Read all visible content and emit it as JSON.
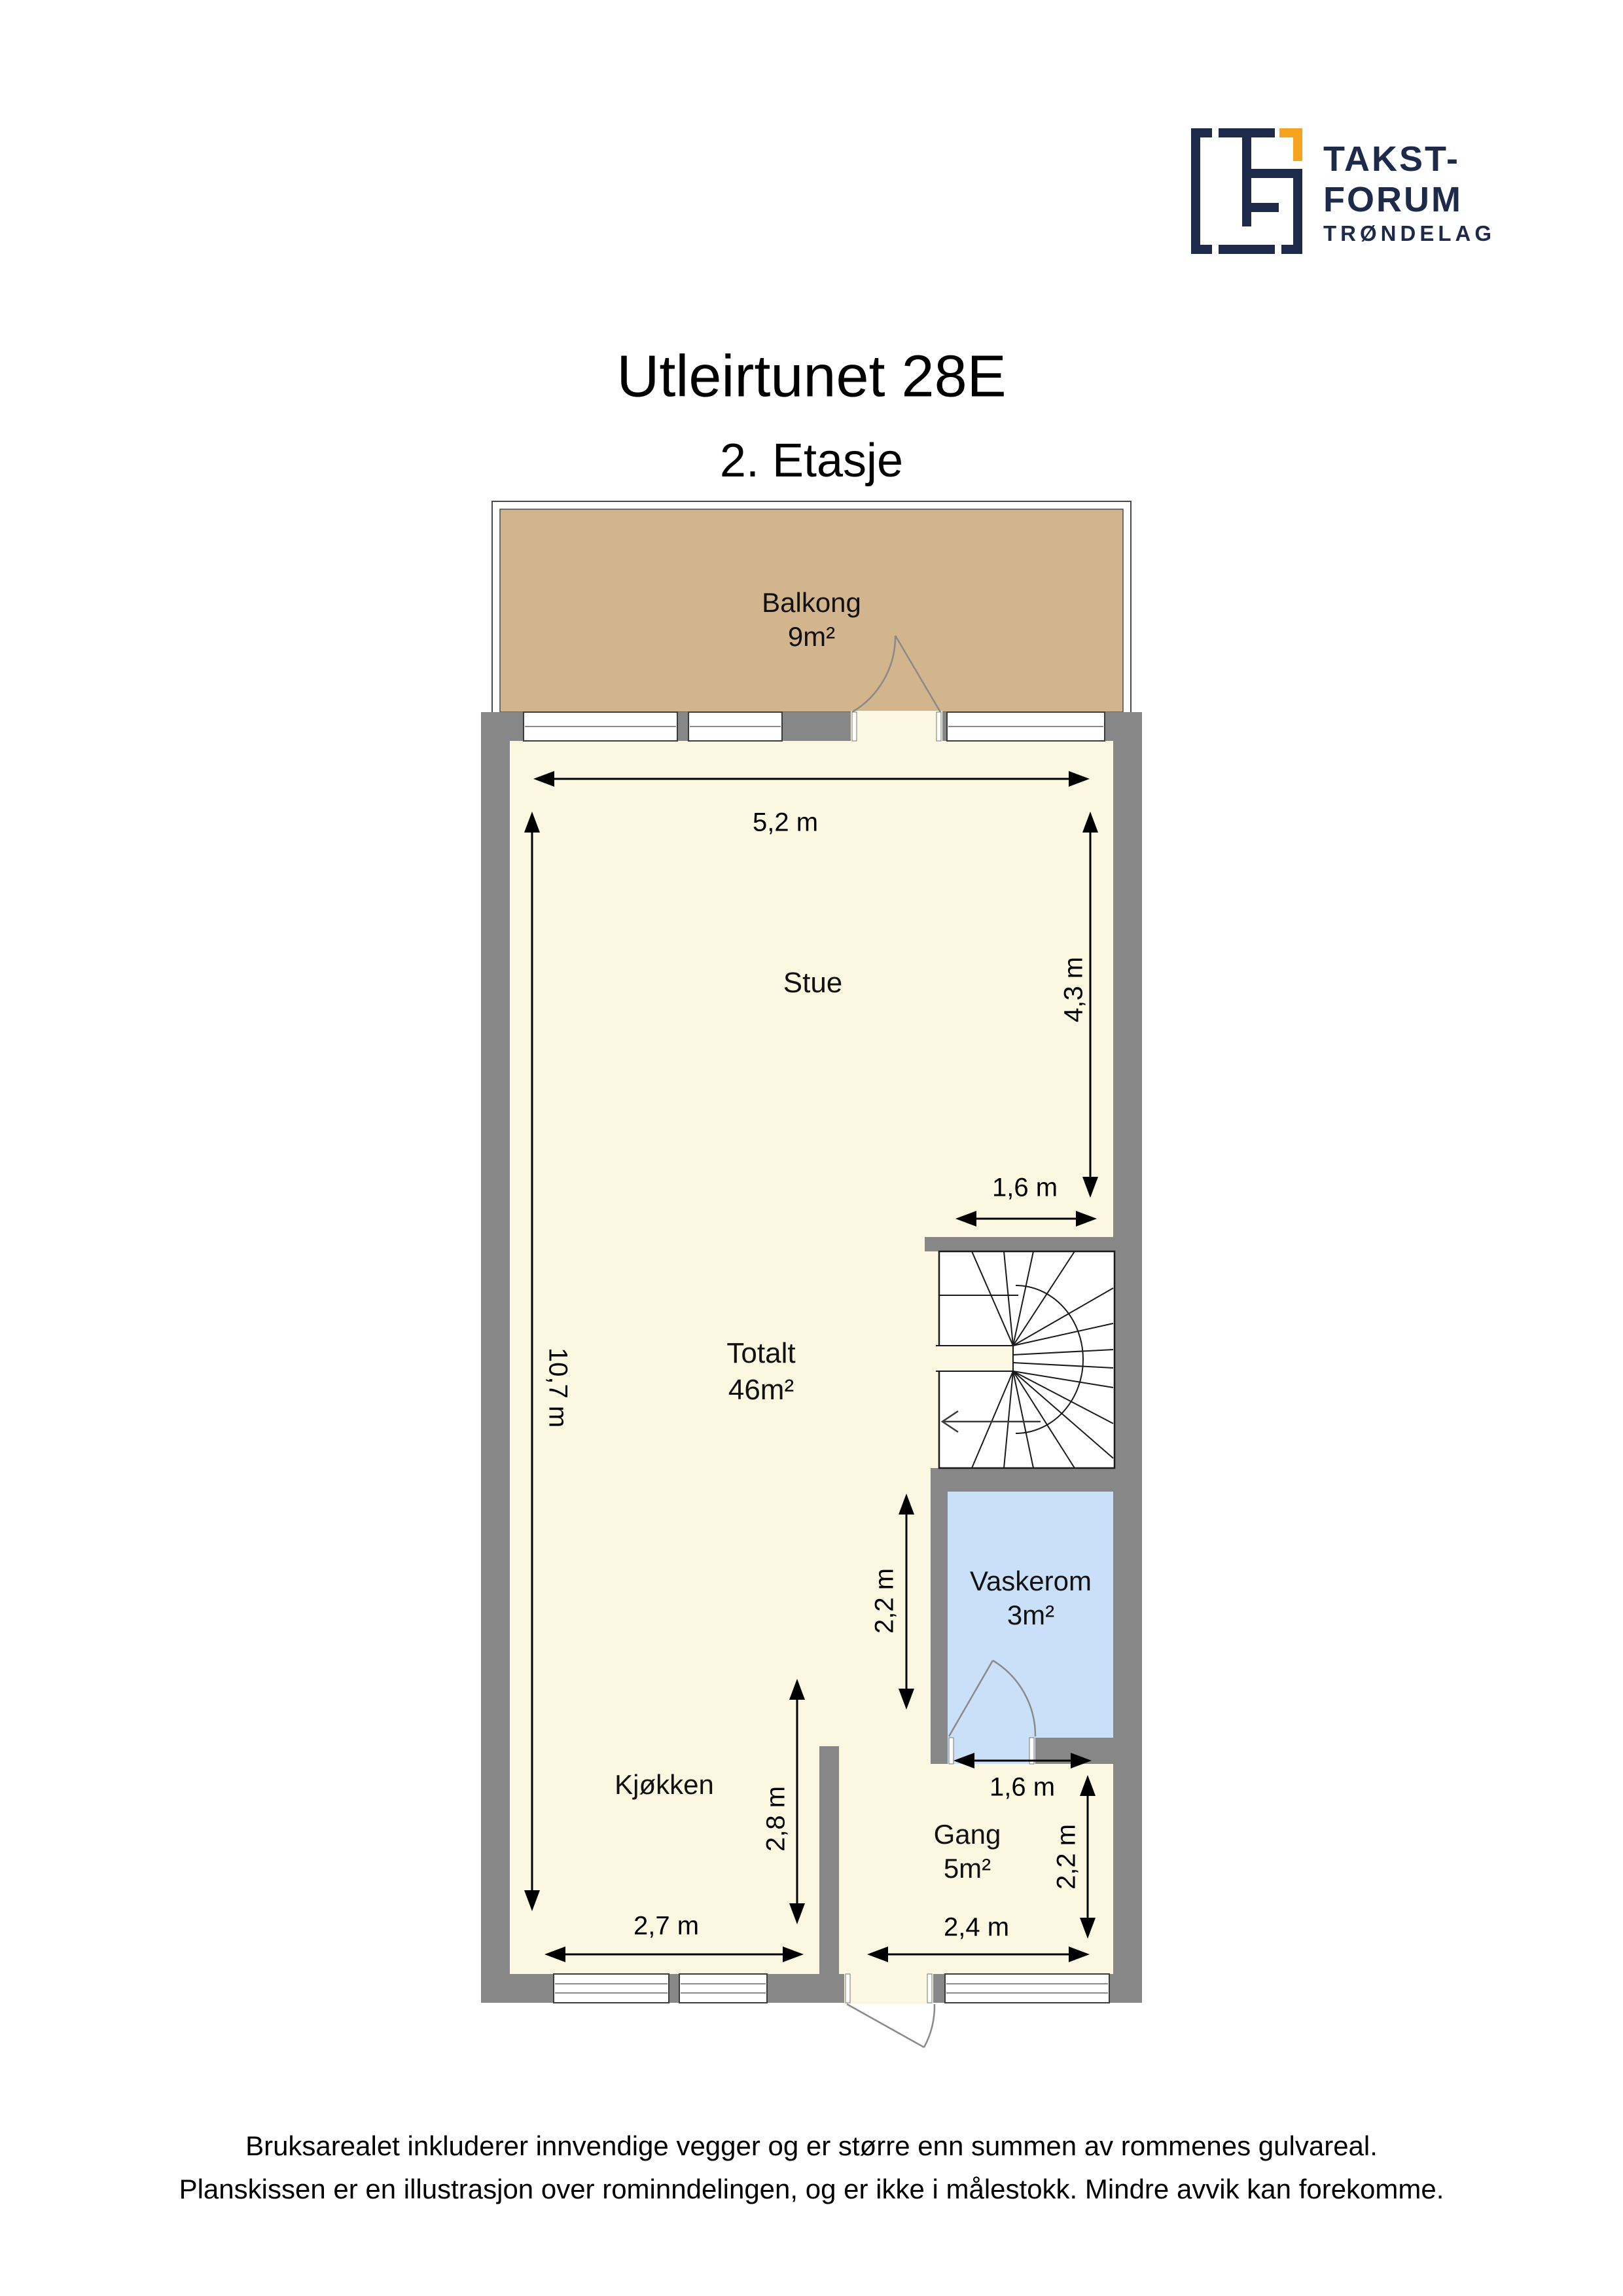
{
  "logo": {
    "brand_line1": "TAKST-",
    "brand_line2": "FORUM",
    "brand_line3": "TRØNDELAG"
  },
  "header": {
    "title": "Utleirtunet 28E",
    "subtitle": "2. Etasje"
  },
  "rooms": {
    "balkong": {
      "label": "Balkong",
      "area": "9m²"
    },
    "stue": {
      "label": "Stue"
    },
    "totalt": {
      "label": "Totalt",
      "area": "46m²"
    },
    "vaskerom": {
      "label": "Vaskerom",
      "area": "3m²"
    },
    "kjokken": {
      "label": "Kjøkken"
    },
    "gang": {
      "label": "Gang",
      "area": "5m²"
    }
  },
  "dimensions": {
    "stue_width": "5,2 m",
    "plan_height": "10,7 m",
    "stue_height": "4,3 m",
    "stair_width": "1,6 m",
    "vaskerom_height": "2,2 m",
    "vaskerom_door_width": "1,6 m",
    "gang_height": "2,2 m",
    "kjokken_height": "2,8 m",
    "kjokken_width": "2,7 m",
    "gang_width": "2,4 m"
  },
  "footer": {
    "line1": "Bruksarealet inkluderer innvendige vegger og er større enn summen av rommenes gulvareal.",
    "line2": "Planskissen er en illustrasjon over rominndelingen, og er ikke i målestokk. Mindre avvik kan forekomme."
  },
  "colors": {
    "brand_navy": "#1d2a49",
    "brand_orange": "#f6a41f",
    "wall_gray": "#878787",
    "floor_cream": "#fbf7e1",
    "balcony_tan": "#d2b58c",
    "laundry_blue": "#c9e0f8"
  }
}
